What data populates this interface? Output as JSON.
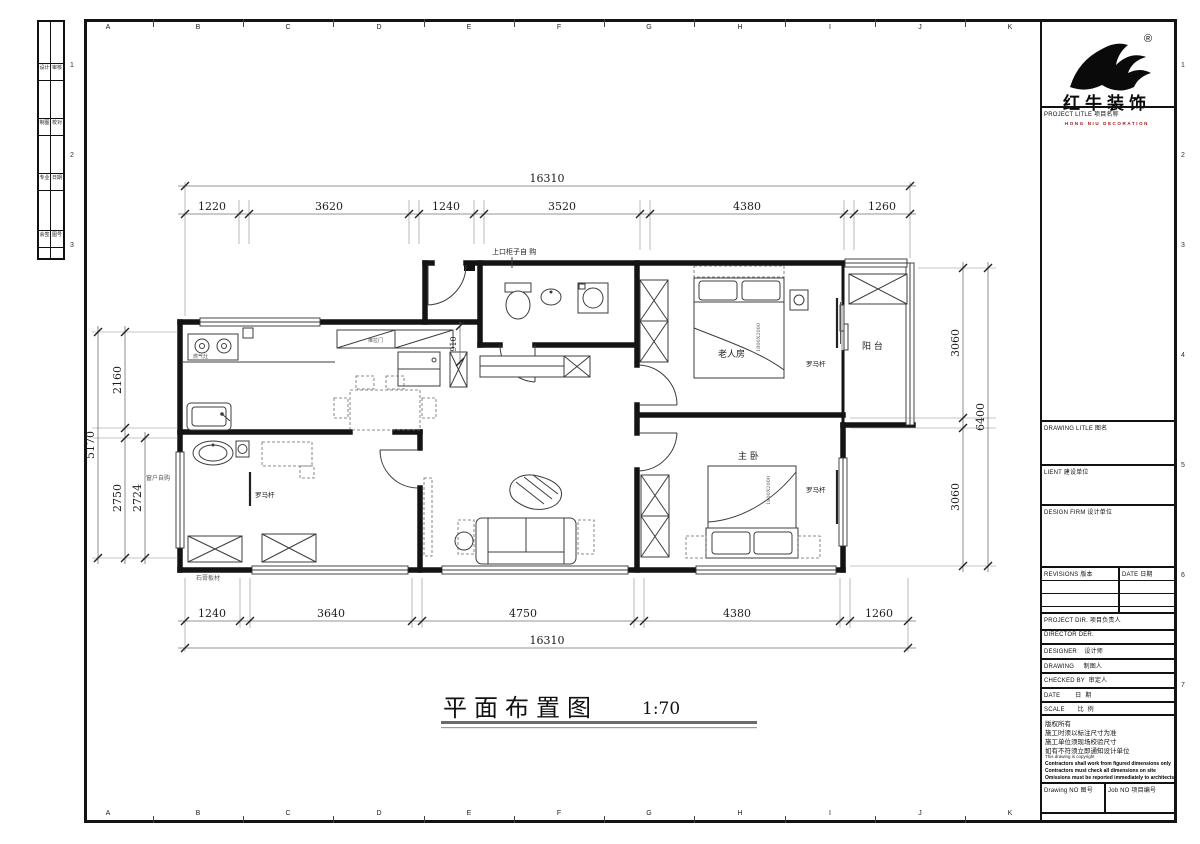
{
  "sheet": {
    "columns": [
      "A",
      "B",
      "C",
      "D",
      "E",
      "F",
      "G",
      "H",
      "I",
      "J",
      "K"
    ],
    "rows": [
      "1",
      "2",
      "3",
      "4",
      "5",
      "6",
      "7"
    ]
  },
  "sign_strip": {
    "cells": [
      [
        "设计",
        "审核"
      ],
      [
        "制图",
        "校对"
      ],
      [
        "专业",
        "日期"
      ],
      [
        "会签",
        "图号"
      ]
    ]
  },
  "logo": {
    "reg": "®",
    "name": "红牛装饰",
    "sub": "HONG NIU DECORATION"
  },
  "titleblock": {
    "project_title": "PROJECT LITLE  项目名称",
    "drawing_title": "DRAWING LITLE  图名",
    "client": "LIENT  建设单位",
    "design_firm": "DESIGN FIRM  设计单位",
    "revisions": "REVISIONS  版本",
    "date_head": "DATE  日期",
    "project_dir": "PROJECT DIR.  项目负责人",
    "director": "DIRECTOR DER.",
    "designer": "DESIGNER    设计师",
    "drawing_by": "DRAWING     制图人",
    "checked_by": "CHECKED BY  审定人",
    "date": "DATE        日  期",
    "scale": "SCALE       比  例",
    "notes_cn": [
      "版权所有",
      "施工时须以标注尺寸为准",
      "施工单位须现场校验尺寸",
      "如有不符须立即通知设计单位"
    ],
    "notes_en": "This drawing is copyright",
    "notes_en_bold": [
      "Contractors shall work from figured dimensions only",
      "Contractors must check all dimensions on site",
      "Omissions must be reported immediately to architects"
    ],
    "drawing_no": "Drawing NO  图号",
    "job_no": "Job NO  项目编号"
  },
  "plan": {
    "title": "平面布置图",
    "scale": "1:70",
    "dims": {
      "top_overall": "16310",
      "top": [
        "1220",
        "3620",
        "1240",
        "3520",
        "4380",
        "1260"
      ],
      "bottom": [
        "1240",
        "3640",
        "4750",
        "4380",
        "1260"
      ],
      "bottom_overall": "16310",
      "left_overall": "5170",
      "left": [
        "2160",
        "2750"
      ],
      "left_inner": "2724",
      "right": [
        "3060",
        "3060"
      ],
      "right_overall": "6400",
      "entry_width": "910"
    },
    "labels": {
      "elder_room": "老人房",
      "balcony": "阳 台",
      "master_room": "主 卧",
      "curtain_rod": "罗马杆",
      "sliding_door": "推拉门",
      "top_cabinet": "上口柜子自 购",
      "window_note": "窗户自购",
      "gypsum_note": "石膏板材",
      "bed_size": "1800X2000",
      "stove": "燃气灶"
    }
  }
}
